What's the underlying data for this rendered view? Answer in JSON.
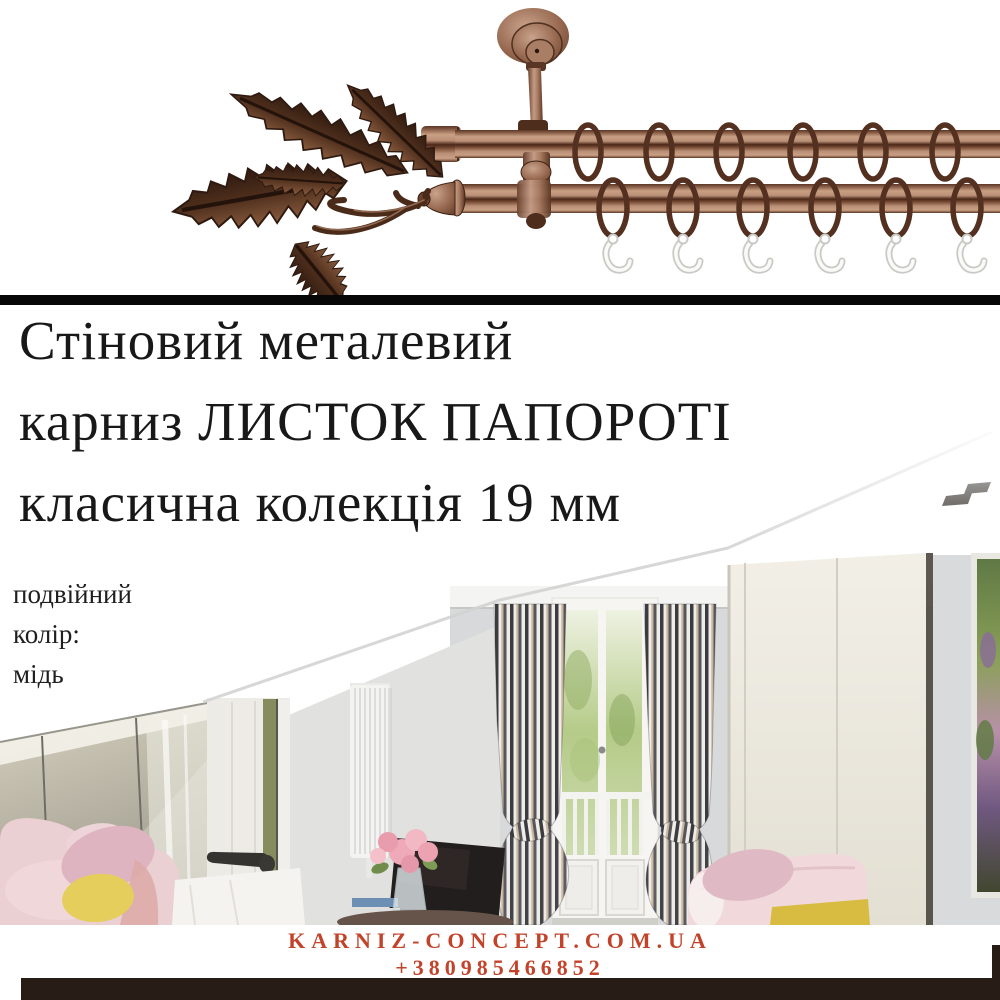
{
  "title": {
    "line1": "Стіновий металевий",
    "line2": "карниз ЛИСТОК ПАПОРОТІ",
    "line3": "класична колекція 19 мм"
  },
  "specs": {
    "line1": "подвійний",
    "line2": "колір:",
    "line3": "мідь"
  },
  "footer": {
    "website": "KARNIZ-CONCEPT.COM.UA",
    "phone": "+380985466852"
  },
  "scene": {
    "product": "double copper curtain rod with fern-leaf finial, wall bracket, rings and white plastic hooks",
    "room": "attic bedroom with sloped ceiling, striped curtains, french balcony window, mirrored wardrobe, pink sofa, peony bouquet and tv"
  },
  "colors": {
    "accent-red": "#c2432a",
    "title-black": "#181818",
    "divider-black": "#070707",
    "bottom-bar-brown": "#281d16",
    "copper-light": "#c9a084",
    "copper-mid": "#8a5f49",
    "copper-dark": "#4a2718",
    "wall-gray": "#d7d9da",
    "wardrobe-cream": "#efece3",
    "sofa-pink": "#eacfd3",
    "pillow-yellow": "#e5ce5c",
    "curtain-dark": "#3c3c40"
  }
}
